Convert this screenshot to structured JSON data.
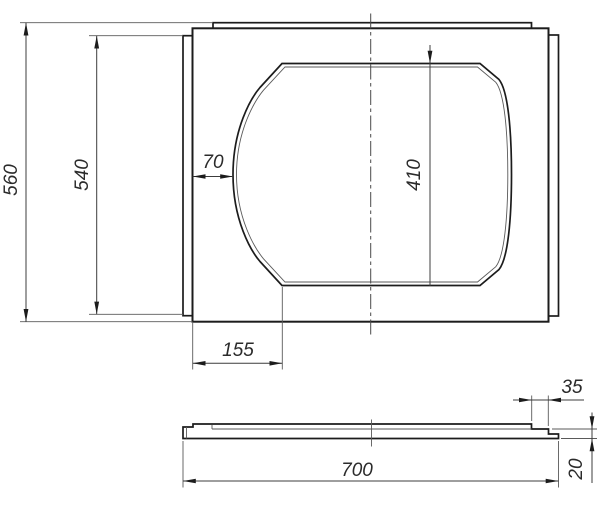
{
  "drawing": {
    "title": "plate-with-oval-cutout",
    "colors": {
      "background": "#ffffff",
      "outline": "#1c1c1c",
      "thin_line": "#5a5a5a",
      "dimension_text": "#2b2b2b"
    },
    "front_view": {
      "dim_height_overall": "560",
      "dim_height_tabs": "540",
      "dim_cutout_side_gap": "70",
      "dim_cutout_height": "410",
      "dim_cutout_bottom_offset": "155"
    },
    "side_view": {
      "dim_width_overall": "700",
      "dim_step_width": "35",
      "dim_thickness": "20"
    }
  }
}
